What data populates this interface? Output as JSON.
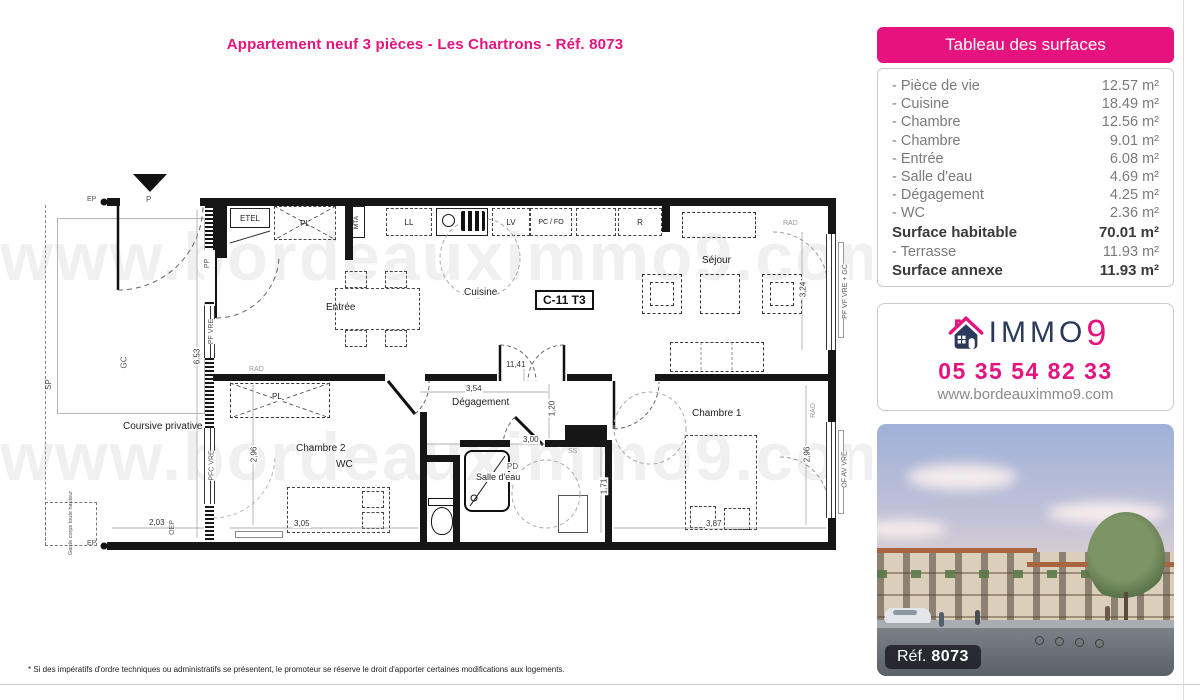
{
  "page": {
    "title": "Appartement neuf 3 pièces - Les Chartrons - Réf. 8073",
    "disclaimer": "* Si des impératifs d'ordre techniques ou administratifs se présentent, le promoteur se réserve le droit d'apporter certaines modifications aux logements."
  },
  "watermark": "www.bordeauximmo9.com",
  "surfaces_panel": {
    "header": "Tableau des surfaces",
    "rows": [
      {
        "label": "- Pièce de vie",
        "value": "12.57 m²"
      },
      {
        "label": "- Cuisine",
        "value": "18.49 m²"
      },
      {
        "label": "- Chambre",
        "value": "12.56 m²"
      },
      {
        "label": "- Chambre",
        "value": "9.01 m²"
      },
      {
        "label": "- Entrée",
        "value": "6.08 m²"
      },
      {
        "label": "- Salle d'eau",
        "value": "4.69 m²"
      },
      {
        "label": "- Dégagement",
        "value": "4.25 m²"
      },
      {
        "label": "- WC",
        "value": "2.36 m²"
      },
      {
        "label": "Surface habitable",
        "value": "70.01 m²"
      },
      {
        "label": "- Terrasse",
        "value": "11.93 m²"
      },
      {
        "label": "Surface annexe",
        "value": "11.93 m²"
      }
    ]
  },
  "agency": {
    "brand_main": "IMMO",
    "brand_digit": "9",
    "phone": "05 35 54 82 33",
    "website": "www.bordeauximmo9.com"
  },
  "photo": {
    "ref_label": "Réf.",
    "ref_value": "8073"
  },
  "plan": {
    "unit": "C-11 T3",
    "rooms": {
      "entree": "Entrée",
      "cuisine": "Cuisine",
      "sejour": "Séjour",
      "degagement": "Dégagement",
      "chambre1": "Chambre 1",
      "chambre2": "Chambre 2",
      "wc": "WC",
      "salle_eau": "Salle d'eau",
      "coursive": "Coursive privative"
    },
    "fixtures": {
      "etel": "ETEL",
      "pl": "PL",
      "mta": "MTA",
      "ll": "LL",
      "lv": "LV",
      "pcfo": "PC / FO",
      "r": "R",
      "rad": "RAD",
      "ss": "SS",
      "pd": "PD"
    },
    "wall_labels": {
      "p": "P",
      "ep": "EP",
      "gc": "GC",
      "sp": "SP",
      "pp": "PP",
      "pf_vre": "PF VRE",
      "pfc_vre": "PFC VRE",
      "oep": "OEP",
      "pf_vf_vre_gc": "PF VF VRE + GC",
      "of_av_vre": "OF AV VRE",
      "garde_corps": "Garde corps toute hauteur"
    },
    "dims": {
      "d653": "6,53",
      "d203": "2,03",
      "d296l": "2,96",
      "d305": "3,05",
      "d1141": "11,41",
      "d354": "3,54",
      "d120": "1,20",
      "d300": "3,00",
      "d171": "1,71",
      "d387": "3,87",
      "d296r": "2,96",
      "d324": "3,24"
    }
  },
  "colors": {
    "pink": "#e6127d",
    "navy": "#2b3a5c"
  }
}
